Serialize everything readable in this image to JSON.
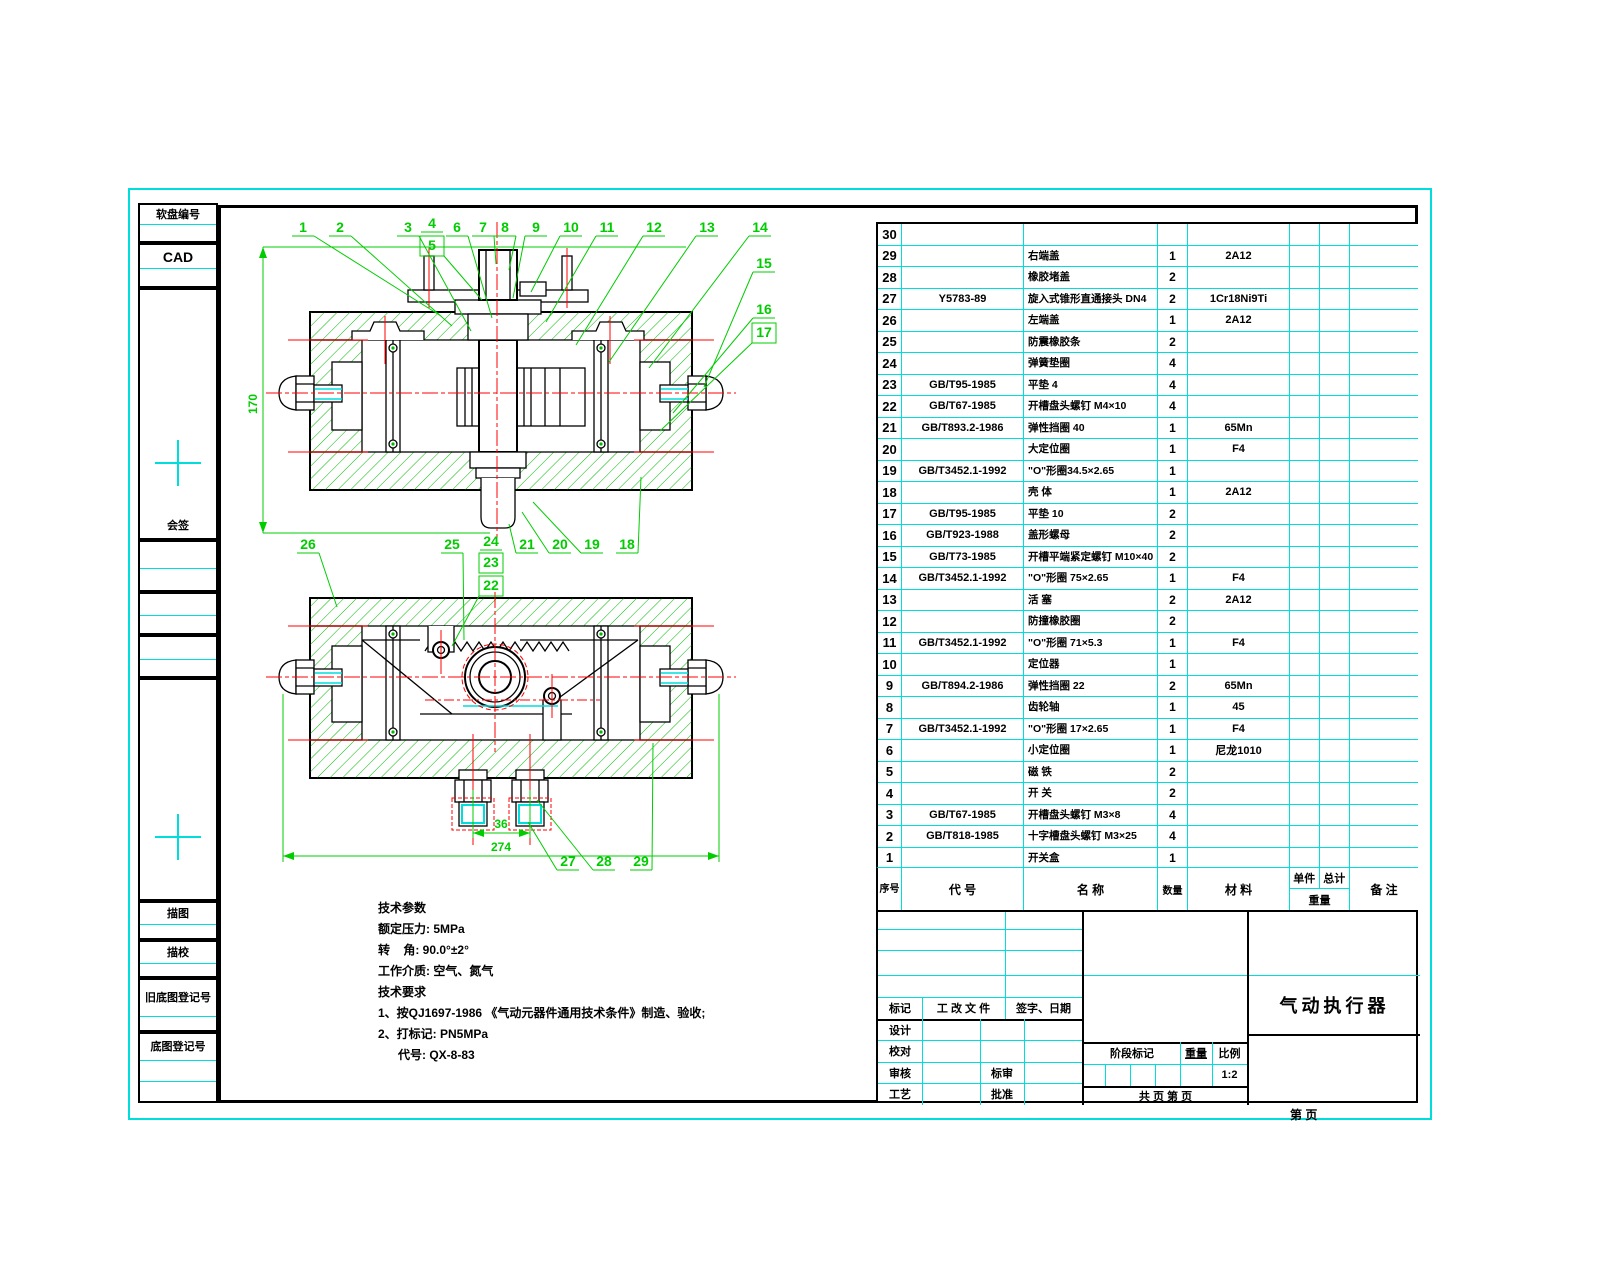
{
  "colors": {
    "border_cyan": "#00dddd",
    "line_green": "#00cc00",
    "hatch_green": "#00bb00",
    "centerline_red": "#ff0000",
    "ink": "#000000"
  },
  "sidebar": {
    "boxes": [
      {
        "label": "软盘编号"
      },
      {
        "label": "CAD"
      },
      {
        "label": "会签"
      },
      {
        "label": "描图"
      },
      {
        "label": "描校"
      },
      {
        "label": "旧底图登记号"
      },
      {
        "label": "底图登记号"
      }
    ]
  },
  "drawing": {
    "callouts": [
      "1",
      "2",
      "3",
      "4",
      "5",
      "6",
      "7",
      "8",
      "9",
      "10",
      "11",
      "12",
      "13",
      "14",
      "15",
      "16",
      "17",
      "18",
      "19",
      "20",
      "21",
      "22",
      "23",
      "24",
      "25",
      "26",
      "27",
      "28",
      "29"
    ],
    "dims": {
      "height": "170",
      "spacing": "36",
      "overall": "274"
    }
  },
  "tech_notes": {
    "params_title": "技术参数",
    "params": [
      "额定压力: 5MPa",
      "转    角: 90.0°±2°",
      "工作介质: 空气、氮气"
    ],
    "req_title": "技术要求",
    "reqs": [
      "1、按QJ1697-1986 《气动元器件通用技术条件》制造、验收;",
      "2、打标记: PN5MPa",
      "      代号: QX-8-83"
    ]
  },
  "parts_table": {
    "headers": {
      "seq": "序号",
      "code": "代  号",
      "name": "名  称",
      "qty": "数量",
      "material": "材  料",
      "weight_unit": "单件",
      "weight_total": "总计",
      "weight": "重量",
      "remark": "备  注"
    },
    "rows": [
      {
        "seq": "30",
        "code": "",
        "name": "",
        "qty": "",
        "material": "",
        "remark": ""
      },
      {
        "seq": "29",
        "code": "",
        "name": "右端盖",
        "qty": "1",
        "material": "2A12",
        "remark": ""
      },
      {
        "seq": "28",
        "code": "",
        "name": "橡胶堵盖",
        "qty": "2",
        "material": "",
        "remark": ""
      },
      {
        "seq": "27",
        "code": "Y5783-89",
        "name": "旋入式锥形直通接头 DN4",
        "qty": "2",
        "material": "1Cr18Ni9Ti",
        "remark": ""
      },
      {
        "seq": "26",
        "code": "",
        "name": "左端盖",
        "qty": "1",
        "material": "2A12",
        "remark": ""
      },
      {
        "seq": "25",
        "code": "",
        "name": "防震橡胶条",
        "qty": "2",
        "material": "",
        "remark": ""
      },
      {
        "seq": "24",
        "code": "",
        "name": "弹簧垫圈",
        "qty": "4",
        "material": "",
        "remark": ""
      },
      {
        "seq": "23",
        "code": "GB/T95-1985",
        "name": "平垫 4",
        "qty": "4",
        "material": "",
        "remark": ""
      },
      {
        "seq": "22",
        "code": "GB/T67-1985",
        "name": "开槽盘头螺钉 M4×10",
        "qty": "4",
        "material": "",
        "remark": ""
      },
      {
        "seq": "21",
        "code": "GB/T893.2-1986",
        "name": "弹性挡圈 40",
        "qty": "1",
        "material": "65Mn",
        "remark": ""
      },
      {
        "seq": "20",
        "code": "",
        "name": "大定位圈",
        "qty": "1",
        "material": "F4",
        "remark": ""
      },
      {
        "seq": "19",
        "code": "GB/T3452.1-1992",
        "name": "\"O\"形圈34.5×2.65",
        "qty": "1",
        "material": "",
        "remark": ""
      },
      {
        "seq": "18",
        "code": "",
        "name": "壳  体",
        "qty": "1",
        "material": "2A12",
        "remark": ""
      },
      {
        "seq": "17",
        "code": "GB/T95-1985",
        "name": "平垫 10",
        "qty": "2",
        "material": "",
        "remark": ""
      },
      {
        "seq": "16",
        "code": "GB/T923-1988",
        "name": "盖形螺母",
        "qty": "2",
        "material": "",
        "remark": ""
      },
      {
        "seq": "15",
        "code": "GB/T73-1985",
        "name": "开槽平端紧定螺钉 M10×40",
        "qty": "2",
        "material": "",
        "remark": ""
      },
      {
        "seq": "14",
        "code": "GB/T3452.1-1992",
        "name": "\"O\"形圈 75×2.65",
        "qty": "1",
        "material": "F4",
        "remark": ""
      },
      {
        "seq": "13",
        "code": "",
        "name": "活  塞",
        "qty": "2",
        "material": "2A12",
        "remark": ""
      },
      {
        "seq": "12",
        "code": "",
        "name": "防撞橡胶圈",
        "qty": "2",
        "material": "",
        "remark": ""
      },
      {
        "seq": "11",
        "code": "GB/T3452.1-1992",
        "name": "\"O\"形圈 71×5.3",
        "qty": "1",
        "material": "F4",
        "remark": ""
      },
      {
        "seq": "10",
        "code": "",
        "name": "定位器",
        "qty": "1",
        "material": "",
        "remark": ""
      },
      {
        "seq": "9",
        "code": "GB/T894.2-1986",
        "name": "弹性挡圈 22",
        "qty": "2",
        "material": "65Mn",
        "remark": ""
      },
      {
        "seq": "8",
        "code": "",
        "name": "齿轮轴",
        "qty": "1",
        "material": "45",
        "remark": ""
      },
      {
        "seq": "7",
        "code": "GB/T3452.1-1992",
        "name": "\"O\"形圈 17×2.65",
        "qty": "1",
        "material": "F4",
        "remark": ""
      },
      {
        "seq": "6",
        "code": "",
        "name": "小定位圈",
        "qty": "1",
        "material": "尼龙1010",
        "remark": ""
      },
      {
        "seq": "5",
        "code": "",
        "name": "磁  铁",
        "qty": "2",
        "material": "",
        "remark": ""
      },
      {
        "seq": "4",
        "code": "",
        "name": "开  关",
        "qty": "2",
        "material": "",
        "remark": ""
      },
      {
        "seq": "3",
        "code": "GB/T67-1985",
        "name": "开槽盘头螺钉 M3×8",
        "qty": "4",
        "material": "",
        "remark": ""
      },
      {
        "seq": "2",
        "code": "GB/T818-1985",
        "name": "十字槽盘头螺钉 M3×25",
        "qty": "4",
        "material": "",
        "remark": ""
      },
      {
        "seq": "1",
        "code": "",
        "name": "开关盒",
        "qty": "1",
        "material": "",
        "remark": ""
      }
    ]
  },
  "title_block": {
    "revision": {
      "mark": "标记",
      "doc": "工 改 文 件",
      "sign": "签字、日期"
    },
    "roles": [
      {
        "label": "设计",
        "label2": ""
      },
      {
        "label": "校对",
        "label2": ""
      },
      {
        "label": "审核",
        "label2": "标审"
      },
      {
        "label": "工艺",
        "label2": "批准"
      }
    ],
    "stage": {
      "stage_mark": "阶段标记",
      "weight": "重量",
      "scale": "比例",
      "scale_value": "1:2"
    },
    "pages_line": "共    页 第    页",
    "product_title": "气动执行器",
    "footer_page": "第    页"
  }
}
